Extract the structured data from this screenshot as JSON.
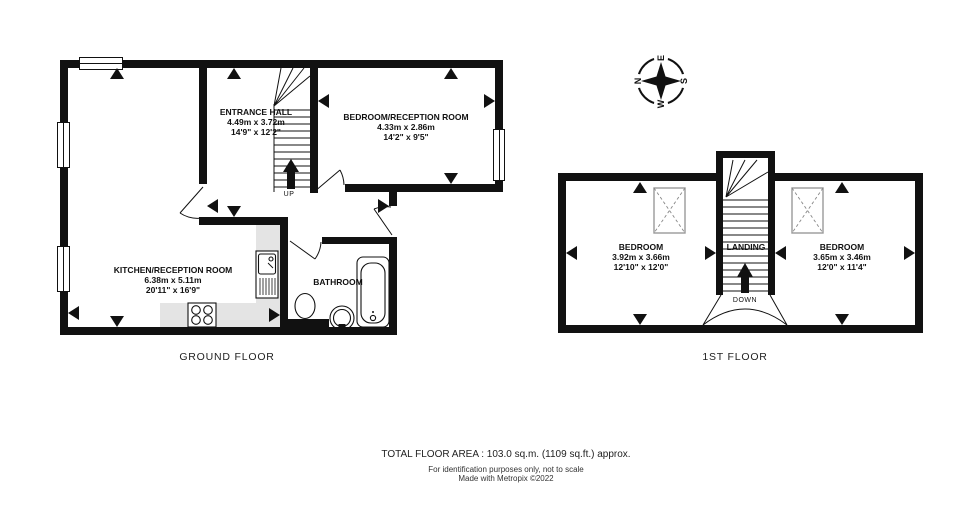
{
  "colors": {
    "wall": "#111111",
    "counter": "#e4e4e4",
    "background": "#ffffff",
    "skylight_border": "#999999"
  },
  "compass": {
    "north": "N",
    "east": "E",
    "south": "S",
    "west": "W"
  },
  "floors": [
    {
      "id": "ground",
      "label": "GROUND FLOOR",
      "stair_label": "UP",
      "rooms": [
        {
          "name": "ENTRANCE HALL",
          "metric": "4.49m  x 3.72m",
          "imperial": "14'9\"  x 12'2\""
        },
        {
          "name": "BEDROOM/RECEPTION ROOM",
          "metric": "4.33m  x 2.86m",
          "imperial": "14'2\"  x 9'5\""
        },
        {
          "name": "KITCHEN/RECEPTION ROOM",
          "metric": "6.38m  x 5.11m",
          "imperial": "20'11\"  x 16'9\""
        },
        {
          "name": "BATHROOM"
        }
      ]
    },
    {
      "id": "first",
      "label": "1ST FLOOR",
      "stair_label": "DOWN",
      "rooms": [
        {
          "name": "BEDROOM",
          "metric": "3.92m  x 3.66m",
          "imperial": "12'10\"  x 12'0\""
        },
        {
          "name": "LANDING"
        },
        {
          "name": "BEDROOM",
          "metric": "3.65m  x 3.46m",
          "imperial": "12'0\"  x 11'4\""
        }
      ]
    }
  ],
  "footer": {
    "total_area": "TOTAL FLOOR AREA : 103.0 sq.m. (1109 sq.ft.) approx.",
    "disclaimer": "For identification purposes only, not to scale",
    "credit": "Made with Metropix ©2022"
  }
}
